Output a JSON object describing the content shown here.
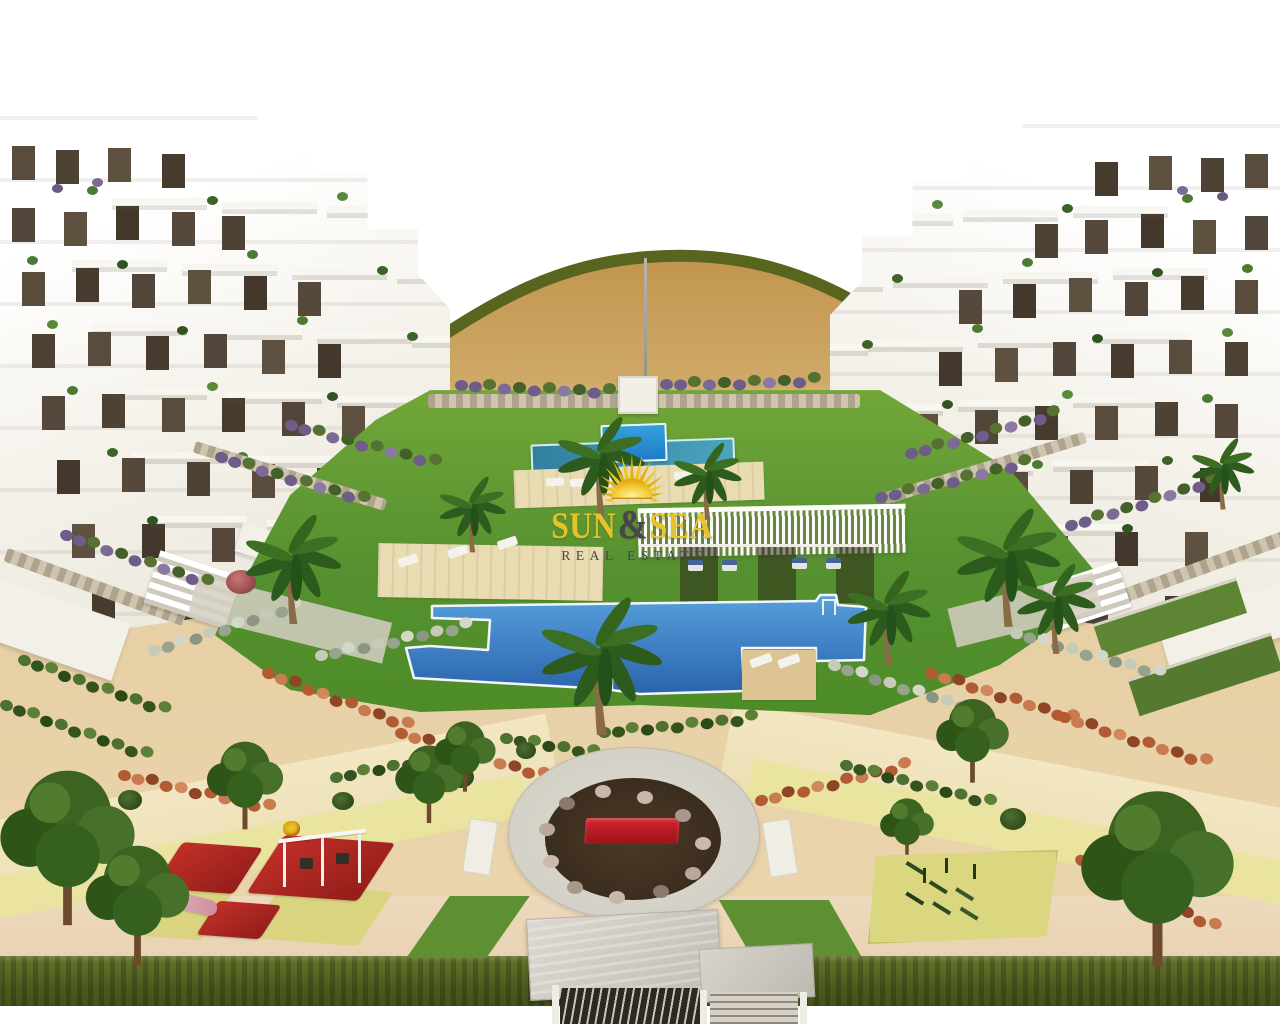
{
  "watermark": {
    "word1": "SUN",
    "ampersand": "&",
    "word2": "SEA",
    "subtitle": "REAL ESTATE"
  },
  "icons": {
    "logo": "sunburst-sun-icon"
  },
  "colors": {
    "brand_yellow": "#e7c32b",
    "brand_text_dark": "#46464a",
    "pool_blue": "#2f9ade",
    "pool_teal": "#3a8fae",
    "pool_deep_blue": "#2a63ac",
    "lawn_green": "#5f9e2f",
    "sand": "#c79d5c",
    "path_cream": "#f2e7c2",
    "path_yellow": "#e9e49c",
    "accent_red": "#c0392b",
    "plaza_red": "#c01820",
    "hedge_olive": "#57651f",
    "building_white": "#ffffff"
  }
}
